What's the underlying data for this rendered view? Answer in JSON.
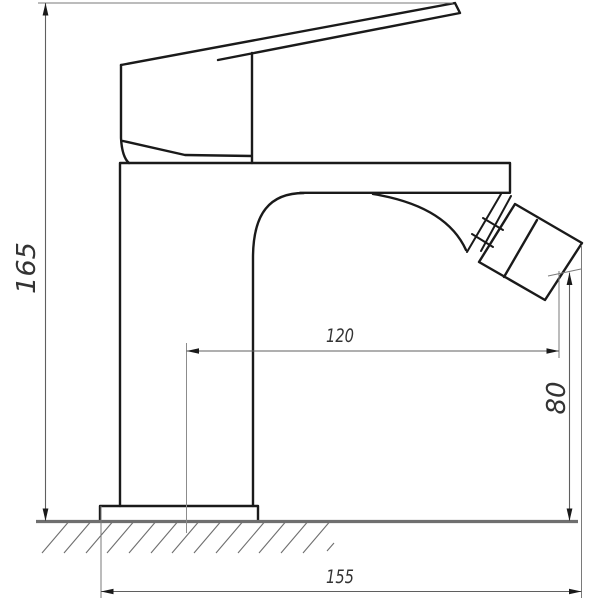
{
  "drawing": {
    "subject": "single-lever bidet faucet side elevation technical drawing",
    "background_color": "#ffffff",
    "outline_color": "#1a1a1a",
    "dimension_line_color": "#5f5f5f",
    "ground_line_color": "#6f6f6f",
    "text_color": "#333333",
    "dimensions": {
      "overall_height_mm": "165",
      "spout_reach_mm": "120",
      "outlet_height_mm": "80",
      "overall_length_mm": "155"
    }
  }
}
